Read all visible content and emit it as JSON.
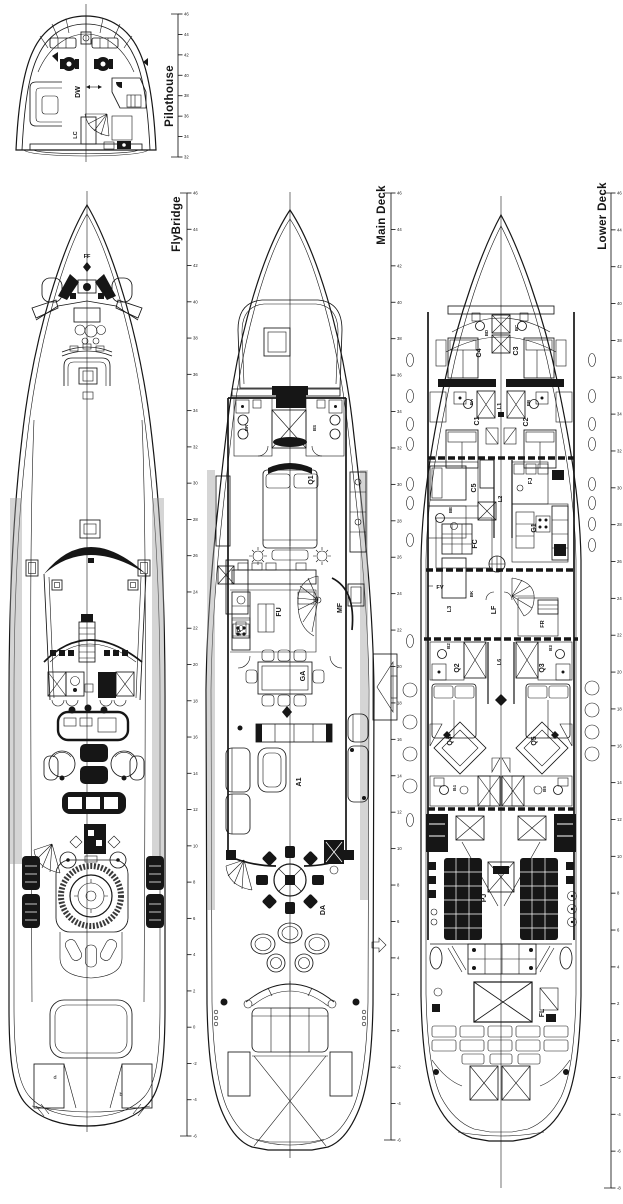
{
  "sheet": {
    "background": "#ffffff",
    "ink": "#161616",
    "shading_grey": "#9a9a9a"
  },
  "decks": {
    "pilothouse": {
      "title": "Pilothouse",
      "labels": {
        "dw": "DW",
        "lc": "LC"
      }
    },
    "flybridge": {
      "title": "FlyBridge",
      "labels": {
        "ff": "FF",
        "d": "d",
        "b": "b"
      }
    },
    "main_deck": {
      "title": "Main Deck",
      "labels": {
        "br": "BR",
        "bs": "BS",
        "q1": "Q1",
        "fu": "FU",
        "fp": "FP",
        "mf": "MF",
        "ga": "GA",
        "a1": "A1",
        "da": "DA"
      }
    },
    "lower_deck": {
      "title": "Lower Deck",
      "labels": {
        "bd": "BD",
        "bc": "BC",
        "c4": "C4",
        "c3": "C3",
        "ba": "BA",
        "bb": "BB",
        "l1": "L1",
        "c1": "C1",
        "c2": "C2",
        "c5": "C5",
        "be": "BE",
        "l2": "L2",
        "fj": "FJ",
        "g1": "G1",
        "fc": "FC",
        "fv": "FV",
        "l3": "L3",
        "bk": "BK",
        "lf": "LF",
        "fr": "FR",
        "b2": "B2",
        "b3": "B3",
        "l6": "L6",
        "q2": "Q2",
        "q3": "Q3",
        "q4": "Q4",
        "q5": "Q5",
        "b4": "B4",
        "b5": "B5",
        "pj": "PJ",
        "fl": "FL"
      }
    }
  },
  "rulers": {
    "pilothouse": {
      "ticks": [
        "46",
        "44",
        "42",
        "40",
        "38",
        "36",
        "34",
        "32"
      ]
    },
    "flybridge": {
      "ticks": [
        "46",
        "44",
        "42",
        "40",
        "38",
        "36",
        "34",
        "32",
        "30",
        "28",
        "26",
        "24",
        "22",
        "20",
        "18",
        "16",
        "14",
        "12",
        "10",
        "8",
        "6",
        "4",
        "2",
        "0",
        "-2",
        "-4",
        "-6"
      ]
    },
    "main_deck": {
      "ticks": [
        "46",
        "44",
        "42",
        "40",
        "38",
        "36",
        "34",
        "32",
        "30",
        "28",
        "26",
        "24",
        "22",
        "20",
        "18",
        "16",
        "14",
        "12",
        "10",
        "8",
        "6",
        "4",
        "2",
        "0",
        "-2",
        "-4",
        "-6"
      ]
    },
    "lower_deck": {
      "ticks": [
        "46",
        "44",
        "42",
        "40",
        "38",
        "36",
        "34",
        "32",
        "30",
        "28",
        "26",
        "24",
        "22",
        "20",
        "18",
        "16",
        "14",
        "12",
        "10",
        "8",
        "6",
        "4",
        "2",
        "0",
        "-2",
        "-4",
        "-6",
        "-8"
      ]
    }
  }
}
